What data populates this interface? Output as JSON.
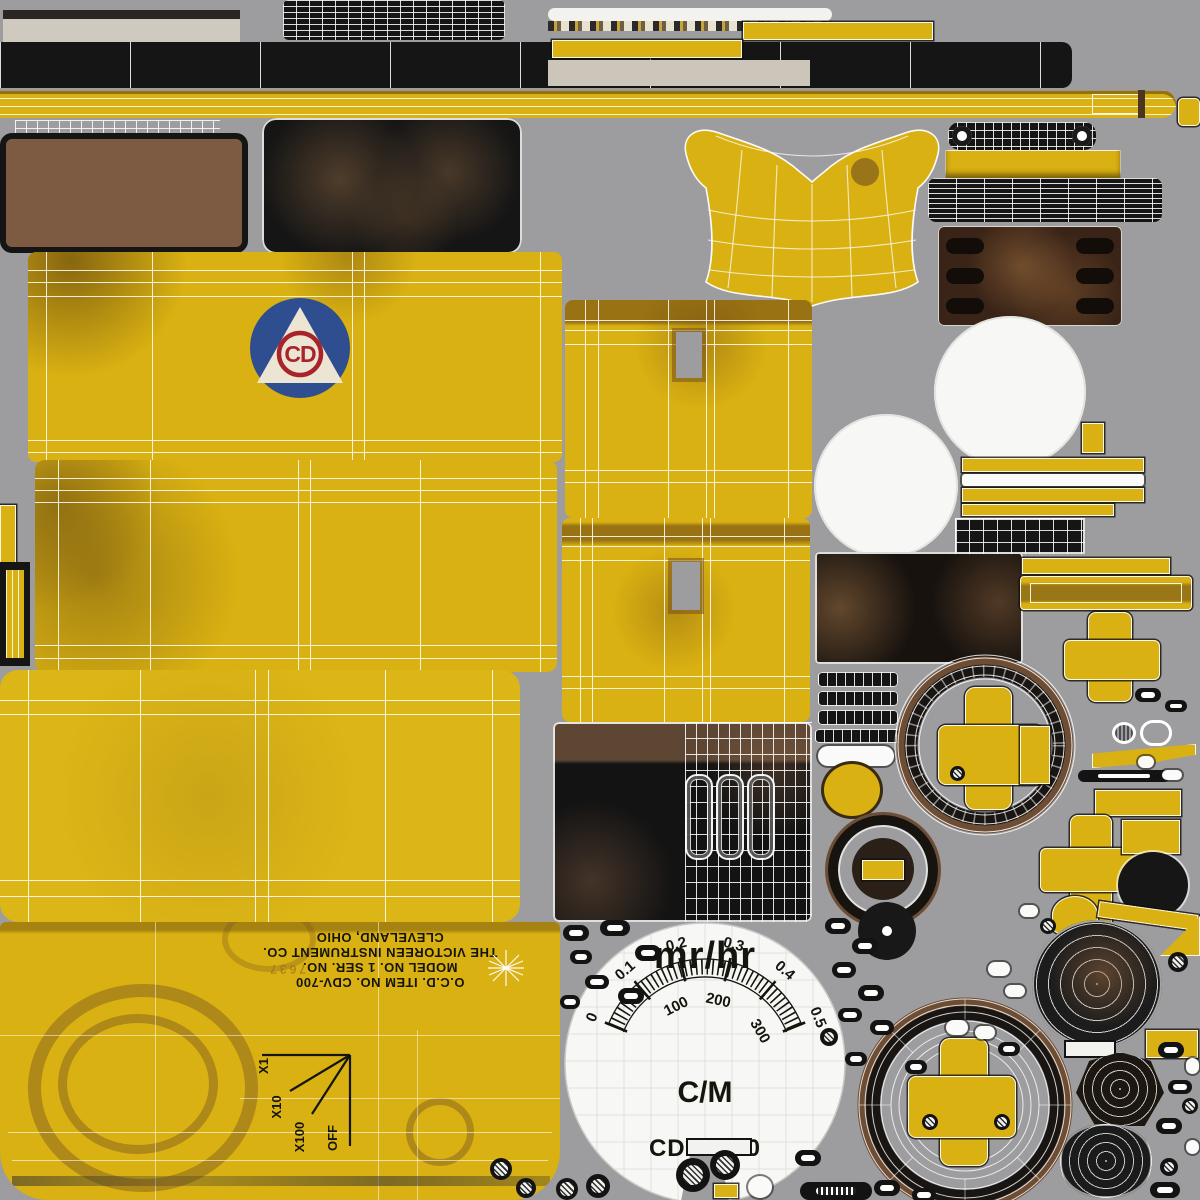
{
  "colors": {
    "background_gray": "#9d9da0",
    "paint_yellow": "#d9b112",
    "panel_black": "#151515",
    "leather_brown": "#7d5a42",
    "rust_brown": "#3a2417",
    "dial_white": "#f7f7f5",
    "wire_white": "#ffffff",
    "logo_blue": "#2e4e90",
    "logo_red": "#a8242a",
    "ink_black": "#15150e"
  },
  "dial": {
    "unit": "mr/hr",
    "outer_scale": [
      "0",
      "0.1",
      "0.2",
      "0.3",
      "0.4",
      "0.5"
    ],
    "inner_scale": [
      "100",
      "200",
      "300"
    ],
    "mode": "C/M",
    "model": "CD V-700"
  },
  "faceplate": {
    "item_line": "O.C.D. ITEM NO. CDV-700",
    "model_line": "MODEL NO. 1 SER. NO.",
    "maker_line": "THE VICTOREEN INSTRUMENT CO.",
    "city_line": "CLEVELAND, OHIO",
    "stamp": "7637",
    "switch": {
      "x1": "X1",
      "x10": "X10",
      "x100": "X100",
      "off": "OFF"
    }
  },
  "logo": {
    "monogram": "CD"
  }
}
